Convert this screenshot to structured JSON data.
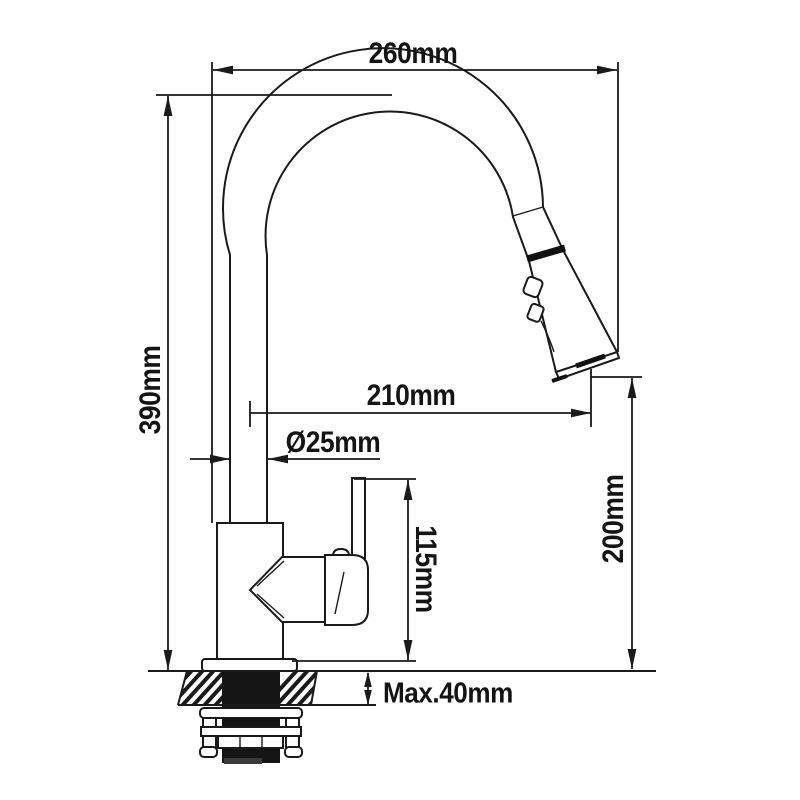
{
  "page": {
    "background": "#ffffff",
    "line_color": "#1a1a1a"
  },
  "diagram": {
    "kind": "technical-dimension-drawing",
    "subject": "pull-down kitchen faucet, side view with mounting hardware",
    "dimensions": {
      "spout_width": {
        "label": "260mm",
        "value": 260,
        "unit": "mm",
        "orientation": "horizontal"
      },
      "total_height": {
        "label": "390mm",
        "value": 390,
        "unit": "mm",
        "orientation": "vertical"
      },
      "spout_reach": {
        "label": "210mm",
        "value": 210,
        "unit": "mm",
        "orientation": "horizontal"
      },
      "pipe_diameter": {
        "label": "Ø25mm",
        "value": 25,
        "unit": "mm",
        "orientation": "horizontal"
      },
      "handle_height": {
        "label": "115mm",
        "value": 115,
        "unit": "mm",
        "orientation": "vertical"
      },
      "outlet_height": {
        "label": "200mm",
        "value": 200,
        "unit": "mm",
        "orientation": "vertical"
      },
      "max_deck_thickness": {
        "label": "Max.40mm",
        "value": 40,
        "unit": "mm",
        "orientation": "vertical"
      }
    }
  }
}
